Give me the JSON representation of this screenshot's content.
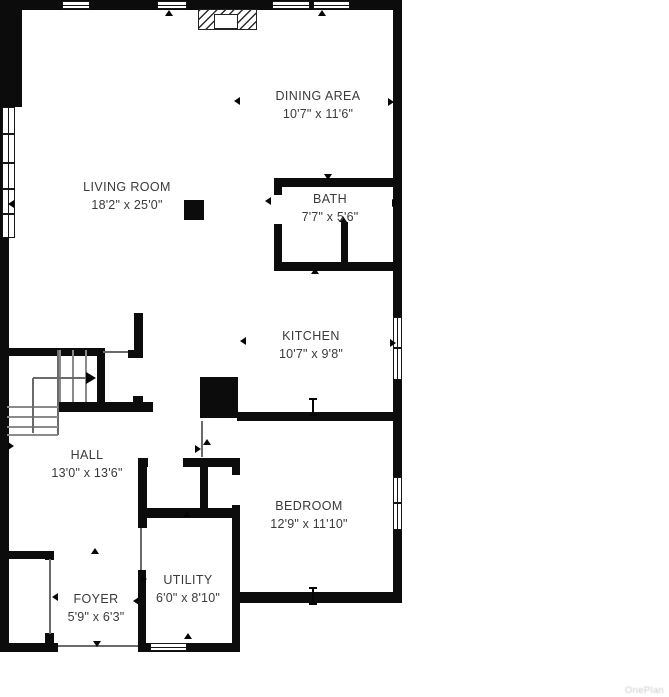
{
  "watermark": "OnePlan",
  "rooms": [
    {
      "name": "LIVING ROOM",
      "dims": "18'2\" x 25'0\"",
      "x": 127,
      "y": 178
    },
    {
      "name": "DINING AREA",
      "dims": "10'7\" x 11'6\"",
      "x": 318,
      "y": 87
    },
    {
      "name": "BATH",
      "dims": "7'7\" x 5'6\"",
      "x": 330,
      "y": 190
    },
    {
      "name": "KITCHEN",
      "dims": "10'7\" x 9'8\"",
      "x": 311,
      "y": 327
    },
    {
      "name": "HALL",
      "dims": "13'0\" x 13'6\"",
      "x": 87,
      "y": 446
    },
    {
      "name": "BEDROOM",
      "dims": "12'9\" x 11'10\"",
      "x": 309,
      "y": 497
    },
    {
      "name": "UTILITY",
      "dims": "6'0\" x 8'10\"",
      "x": 188,
      "y": 571
    },
    {
      "name": "FOYER",
      "dims": "5'9\" x 6'3\"",
      "x": 96,
      "y": 590
    }
  ],
  "colors": {
    "wall": "#0c0c0c",
    "text": "#3a3a3a",
    "marker": "#050505",
    "watermark": "#cccccc"
  },
  "plan": {
    "walls": [
      [
        0,
        0,
        402,
        10
      ],
      [
        0,
        0,
        9,
        652
      ],
      [
        9,
        8,
        13,
        99
      ],
      [
        393,
        0,
        9,
        603
      ],
      [
        232,
        592,
        170,
        11
      ],
      [
        0,
        643,
        58,
        9
      ],
      [
        138,
        643,
        102,
        9
      ],
      [
        274,
        178,
        128,
        9
      ],
      [
        274,
        187,
        8,
        8
      ],
      [
        274,
        224,
        8,
        47
      ],
      [
        341,
        222,
        7,
        49
      ],
      [
        274,
        262,
        128,
        9
      ],
      [
        237,
        412,
        165,
        9
      ],
      [
        200,
        377,
        38,
        41
      ],
      [
        184,
        200,
        20,
        20
      ],
      [
        5,
        348,
        98,
        8
      ],
      [
        128,
        350,
        15,
        8
      ],
      [
        134,
        313,
        9,
        45
      ],
      [
        97,
        348,
        8,
        56
      ],
      [
        58,
        402,
        95,
        10
      ],
      [
        133,
        396,
        10,
        13
      ],
      [
        138,
        458,
        10,
        9
      ],
      [
        183,
        458,
        57,
        9
      ],
      [
        200,
        458,
        8,
        60
      ],
      [
        232,
        458,
        8,
        17
      ],
      [
        232,
        505,
        8,
        13
      ],
      [
        138,
        508,
        102,
        10
      ],
      [
        138,
        458,
        9,
        70
      ],
      [
        138,
        570,
        8,
        75
      ],
      [
        232,
        518,
        8,
        133
      ],
      [
        5,
        551,
        48,
        8
      ],
      [
        45,
        551,
        9,
        9
      ],
      [
        45,
        633,
        9,
        10
      ]
    ],
    "thin_lines": [
      [
        50,
        559,
        50,
        634
      ],
      [
        141,
        528,
        141,
        570
      ],
      [
        58,
        646,
        138,
        646
      ],
      [
        202,
        421,
        202,
        457
      ],
      [
        58,
        350,
        58,
        435
      ],
      [
        103,
        352,
        128,
        352
      ]
    ],
    "stairs": {
      "vertical_treads": {
        "xs": [
          60,
          73,
          86
        ],
        "y1": 350,
        "y2": 402
      },
      "horizontal_treads": {
        "ys": [
          407,
          417,
          427,
          435
        ],
        "x1": 7,
        "x2": 58
      },
      "up_arrow": {
        "vline": [
          33,
          378,
          33,
          433
        ],
        "hline": [
          33,
          378,
          88,
          378
        ],
        "head": [
          91,
          378
        ]
      }
    },
    "windows": [
      {
        "x": 62,
        "y": 1,
        "w": 28,
        "h": 8,
        "o": "h"
      },
      {
        "x": 157,
        "y": 1,
        "w": 30,
        "h": 8,
        "o": "h"
      },
      {
        "x": 272,
        "y": 1,
        "w": 38,
        "h": 8,
        "o": "h"
      },
      {
        "x": 313,
        "y": 1,
        "w": 37,
        "h": 8,
        "o": "h"
      },
      {
        "x": 2,
        "y": 107,
        "w": 13,
        "h": 131,
        "o": "v"
      },
      {
        "x": 393,
        "y": 317,
        "w": 9,
        "h": 63,
        "o": "v"
      },
      {
        "x": 393,
        "y": 477,
        "w": 9,
        "h": 53,
        "o": "v"
      },
      {
        "x": 150,
        "y": 643,
        "w": 37,
        "h": 8,
        "o": "h"
      }
    ],
    "mullions": [
      [
        2,
        133,
        13,
        2
      ],
      [
        2,
        162,
        13,
        2
      ],
      [
        2,
        188,
        13,
        2
      ],
      [
        2,
        213,
        13,
        2
      ],
      [
        393,
        347,
        9,
        2
      ],
      [
        393,
        502,
        9,
        2
      ]
    ],
    "door_markers": [
      {
        "x": 169,
        "y": 13,
        "dir": "up"
      },
      {
        "x": 322,
        "y": 13,
        "dir": "up"
      },
      {
        "x": 237,
        "y": 101,
        "dir": "left"
      },
      {
        "x": 391,
        "y": 102,
        "dir": "right"
      },
      {
        "x": 11,
        "y": 204,
        "dir": "left"
      },
      {
        "x": 328,
        "y": 177,
        "dir": "down"
      },
      {
        "x": 268,
        "y": 201,
        "dir": "left"
      },
      {
        "x": 395,
        "y": 203,
        "dir": "right"
      },
      {
        "x": 343,
        "y": 219,
        "dir": "up"
      },
      {
        "x": 315,
        "y": 271,
        "dir": "up"
      },
      {
        "x": 243,
        "y": 341,
        "dir": "left"
      },
      {
        "x": 393,
        "y": 343,
        "dir": "right"
      },
      {
        "x": 11,
        "y": 446,
        "dir": "right"
      },
      {
        "x": 207,
        "y": 442,
        "dir": "up"
      },
      {
        "x": 198,
        "y": 449,
        "dir": "right"
      },
      {
        "x": 187,
        "y": 514,
        "dir": "up"
      },
      {
        "x": 95,
        "y": 551,
        "dir": "up"
      },
      {
        "x": 144,
        "y": 579,
        "dir": "right"
      },
      {
        "x": 136,
        "y": 601,
        "dir": "left"
      },
      {
        "x": 55,
        "y": 597,
        "dir": "left"
      },
      {
        "x": 188,
        "y": 636,
        "dir": "up"
      },
      {
        "x": 97,
        "y": 644,
        "dir": "down"
      }
    ],
    "i_markers": [
      [
        313,
        399
      ],
      [
        313,
        588
      ]
    ],
    "fireplace": {
      "x": 198,
      "y": 9,
      "w": 59,
      "h": 21,
      "box": {
        "x": 214,
        "y": 14,
        "w": 24,
        "h": 15
      }
    }
  }
}
